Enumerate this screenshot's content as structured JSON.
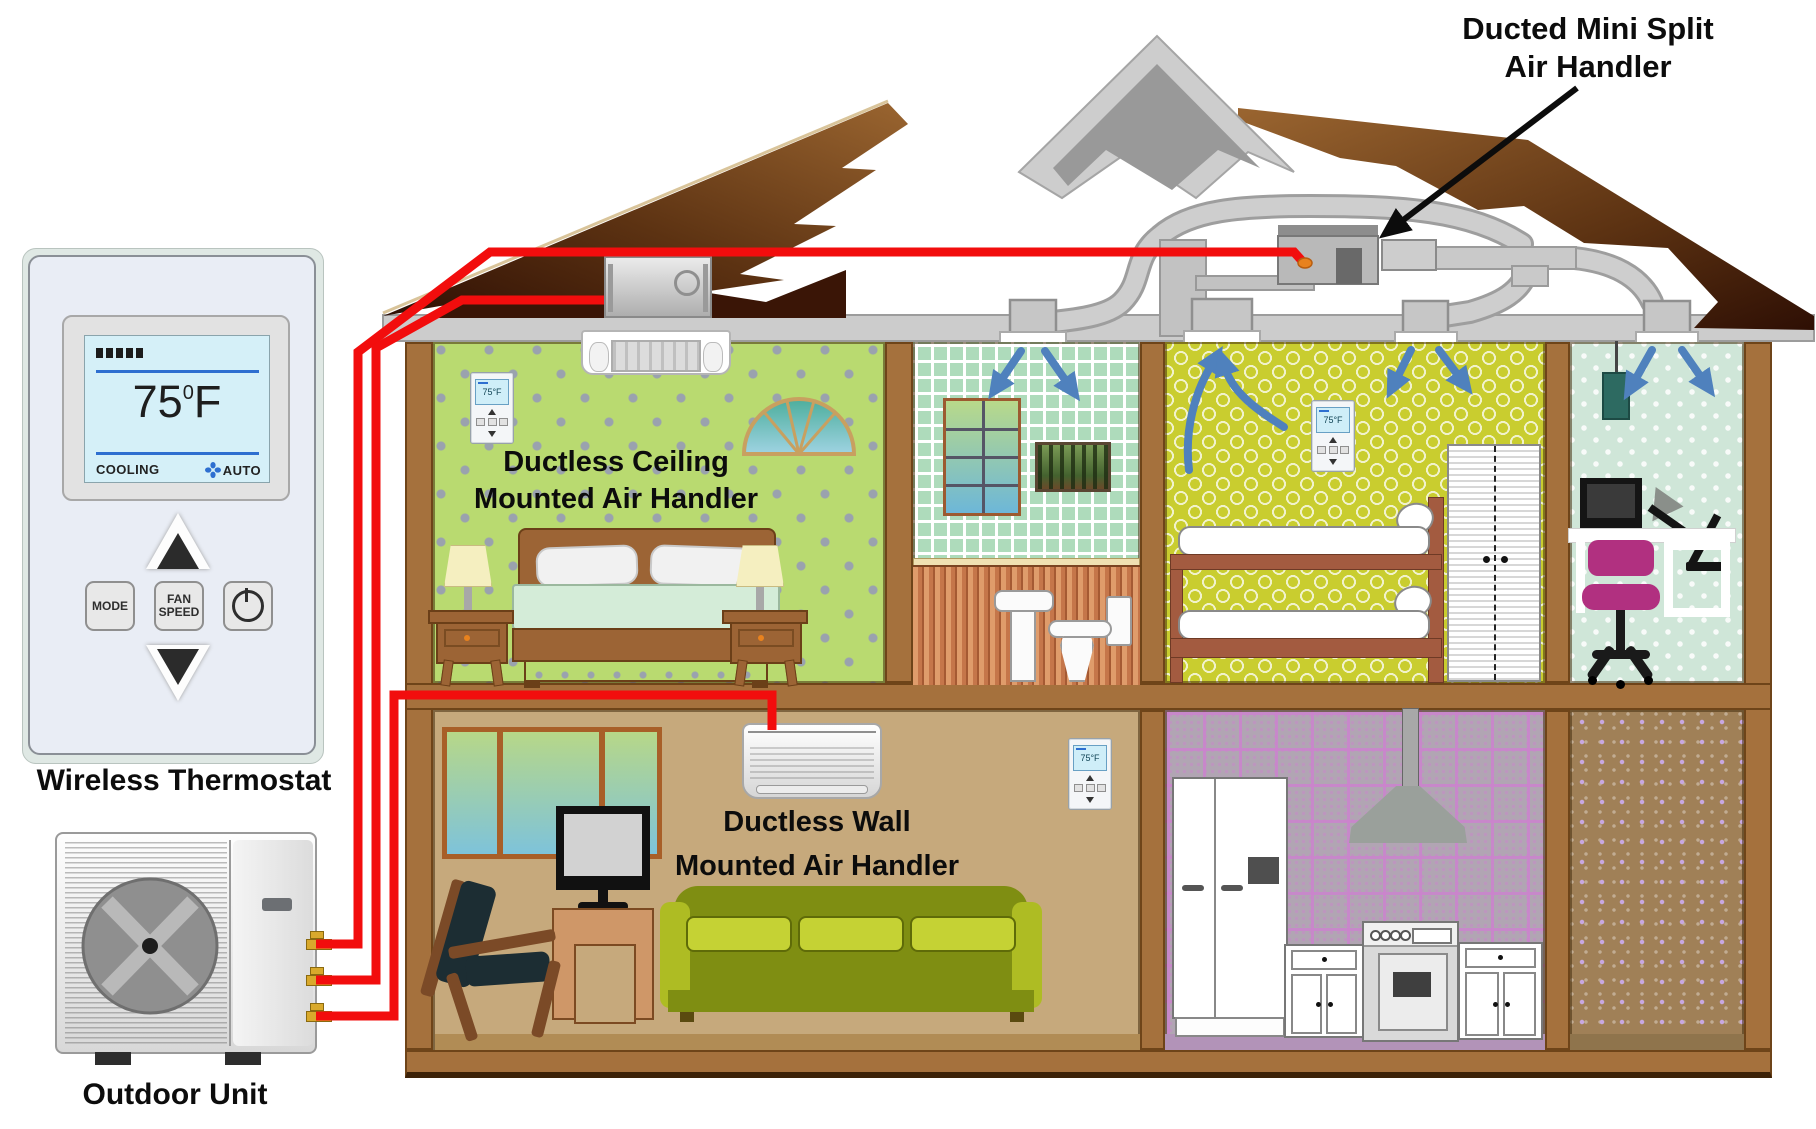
{
  "labels": {
    "ducted": {
      "line1": "Ducted Mini Split",
      "line2": "Air Handler"
    },
    "ceiling": {
      "line1": "Ductless Ceiling",
      "line2": "Mounted Air Handler"
    },
    "wall": {
      "line1": "Ductless Wall",
      "line2": "Mounted Air Handler"
    },
    "wireless_thermostat": "Wireless Thermostat",
    "outdoor_unit": "Outdoor Unit"
  },
  "wireless_thermostat": {
    "display": {
      "signal_bars": 5,
      "temperature": "75",
      "degree": "0",
      "unit": "F",
      "status_left": "COOLING",
      "status_right": "AUTO"
    },
    "buttons": {
      "mode": "MODE",
      "fan_line1": "FAN",
      "fan_line2": "SPEED"
    }
  },
  "wall_thermostat": {
    "temperature": "75°F"
  },
  "colors": {
    "refrigerant_line": "#F20D0D",
    "airflow_arrow": "#4F81BD",
    "duct_gray": "#CECECE",
    "roof_brown_light": "#9A6530",
    "roof_brown_dark": "#2E0F04",
    "structure_brown": "#A5713D",
    "connector_orange": "#E8821E",
    "lcd_blue": "#2E6FD0"
  }
}
